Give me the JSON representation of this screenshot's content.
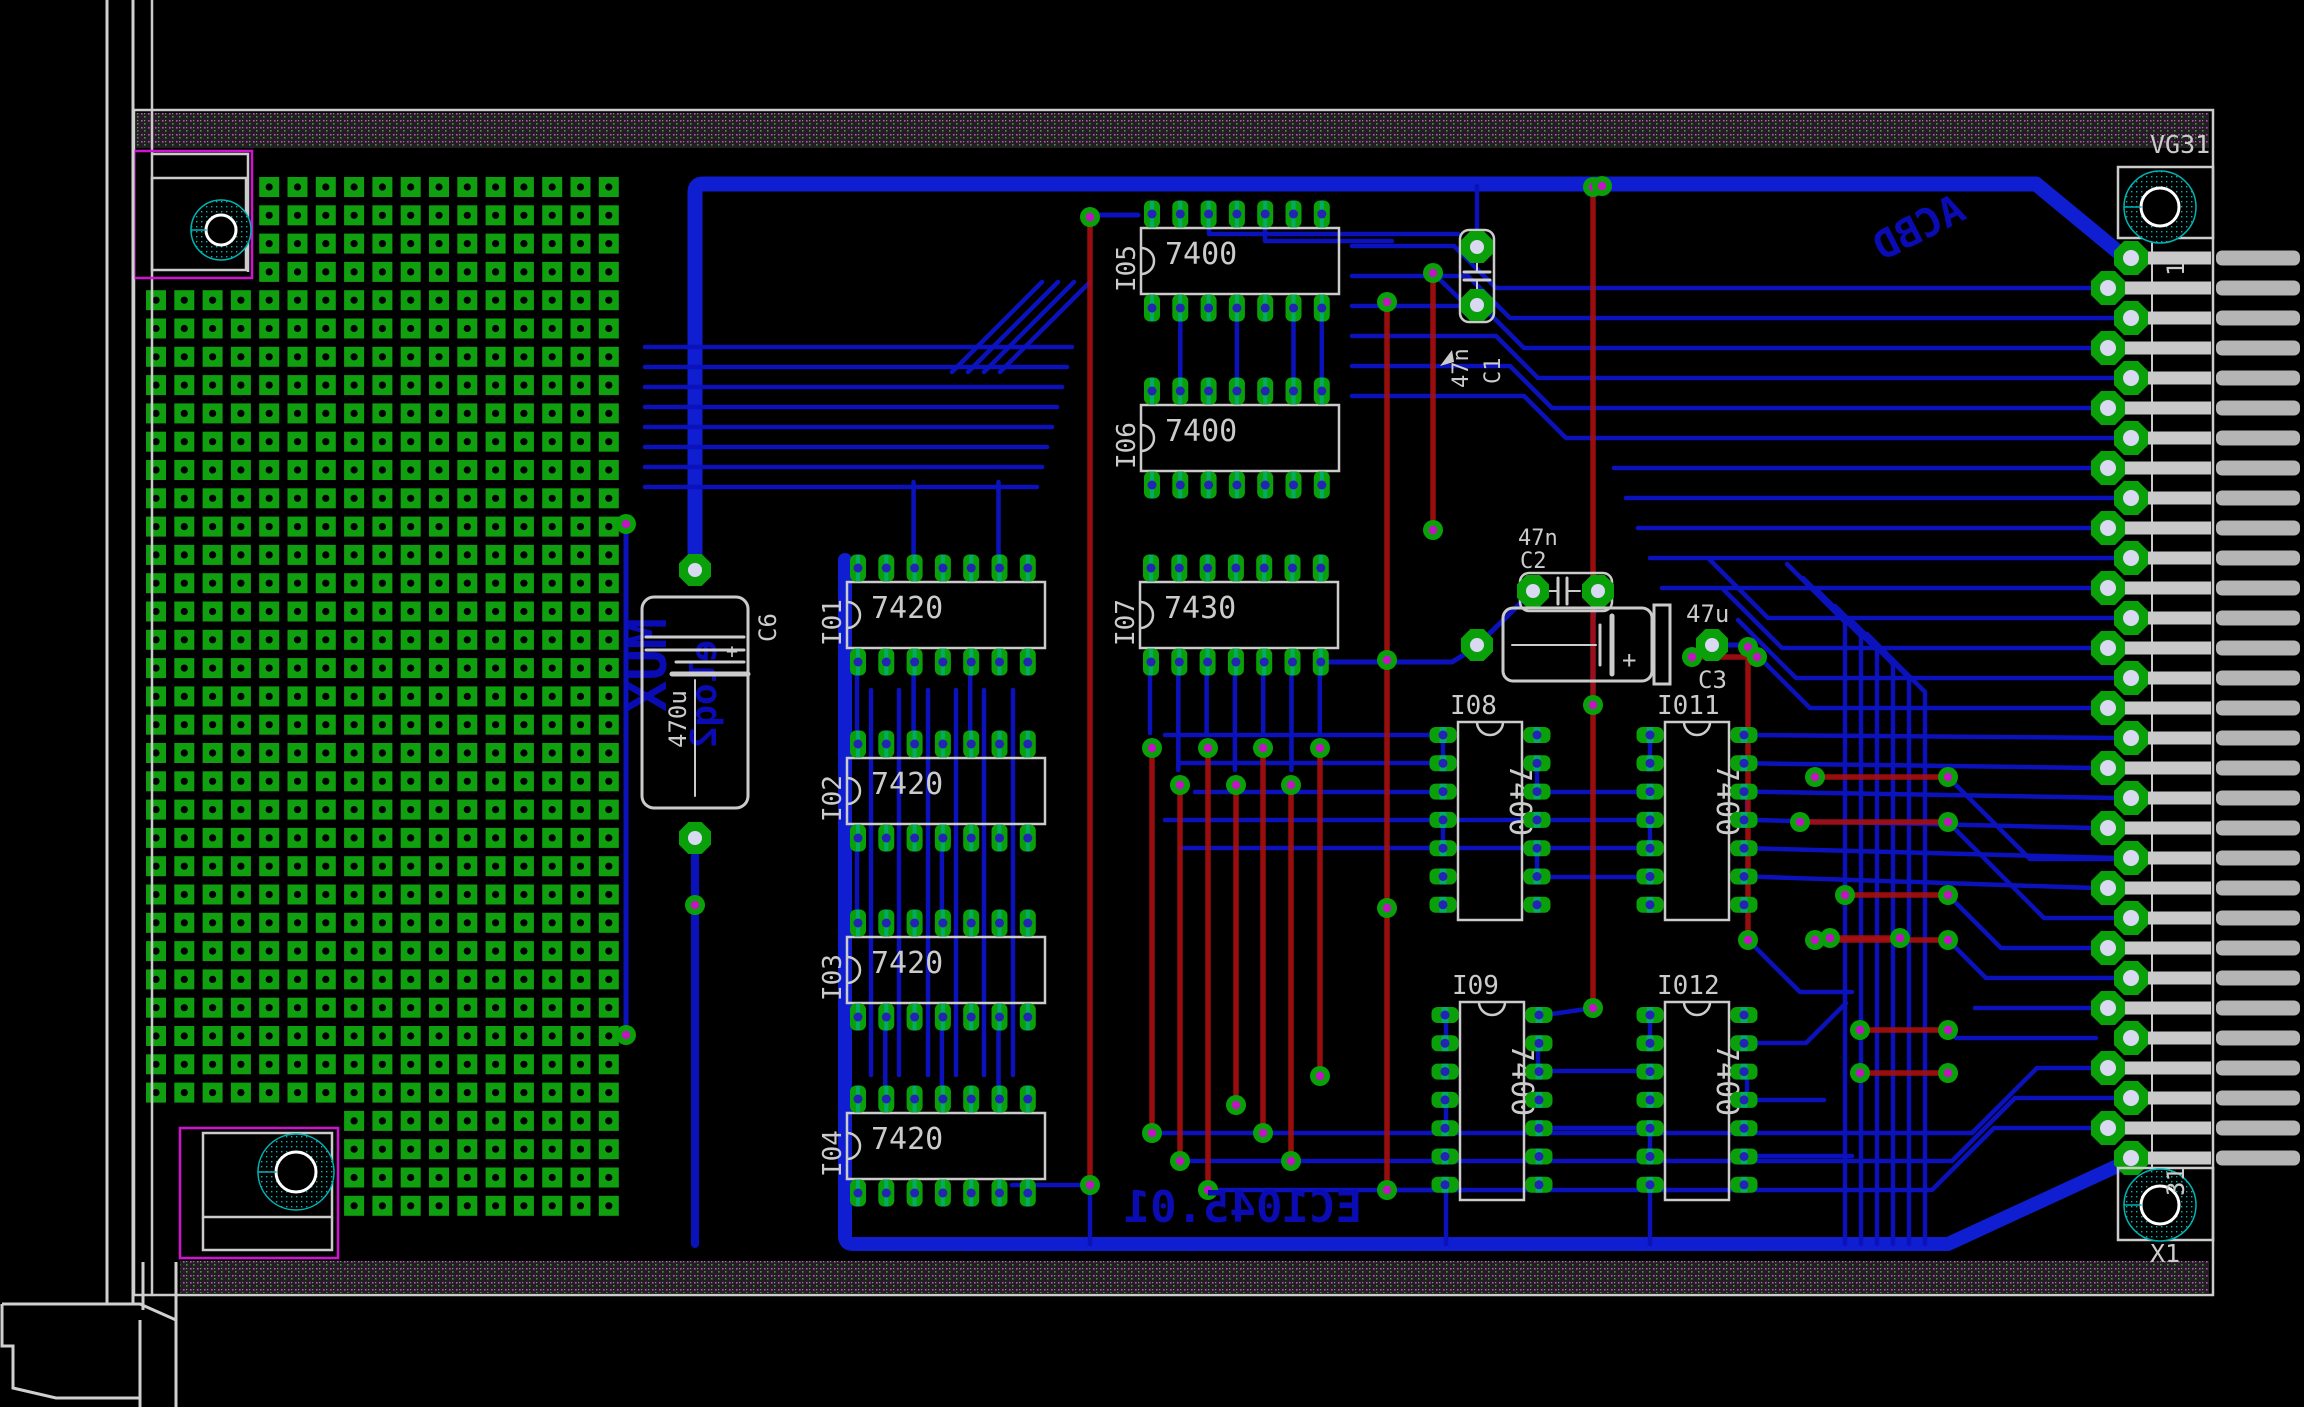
{
  "board": {
    "silkscreen": {
      "connector_label": "VG31",
      "connector_ref": "X1",
      "pin_first_label": "1",
      "pin_last_label": "31"
    },
    "copper_texts": {
      "acbd": "ACBD",
      "board_id": "EC1045.01",
      "mux": "MUX",
      "misc": "eloq2"
    },
    "connector": {
      "pins": 31
    },
    "proto_grid": {
      "cols": 17,
      "rows": 37
    },
    "components": [
      {
        "ref": "I01",
        "value": "7420",
        "type": "dip-h",
        "x": 847,
        "y": 582
      },
      {
        "ref": "I02",
        "value": "7420",
        "type": "dip-h",
        "x": 847,
        "y": 758
      },
      {
        "ref": "I03",
        "value": "7420",
        "type": "dip-h",
        "x": 847,
        "y": 937
      },
      {
        "ref": "I04",
        "value": "7420",
        "type": "dip-h",
        "x": 847,
        "y": 1113
      },
      {
        "ref": "I05",
        "value": "7400",
        "type": "dip-h",
        "x": 1141,
        "y": 228
      },
      {
        "ref": "I06",
        "value": "7400",
        "type": "dip-h",
        "x": 1141,
        "y": 405
      },
      {
        "ref": "I07",
        "value": "7430",
        "type": "dip-h",
        "x": 1140,
        "y": 582
      },
      {
        "ref": "I08",
        "value": "7400",
        "type": "dip-v",
        "x": 1458,
        "y": 722
      },
      {
        "ref": "I011",
        "value": "7400",
        "type": "dip-v",
        "x": 1665,
        "y": 722
      },
      {
        "ref": "I09",
        "value": "7400",
        "type": "dip-v",
        "x": 1460,
        "y": 1002
      },
      {
        "ref": "I012",
        "value": "7400",
        "type": "dip-v",
        "x": 1665,
        "y": 1002
      },
      {
        "ref": "C1",
        "value": "47n",
        "type": "cap-v",
        "x": 1460,
        "y": 230
      },
      {
        "ref": "C2",
        "value": "47n",
        "type": "cap-h",
        "x": 1520,
        "y": 573
      },
      {
        "ref": "C3",
        "value": "47u",
        "type": "elco-h",
        "x": 1503,
        "y": 608
      },
      {
        "ref": "C6",
        "value": "470u",
        "type": "elco-v",
        "x": 642,
        "y": 597
      }
    ],
    "colors": {
      "bg": "#000000",
      "silk": "#cbcbcb",
      "trace": "#0b12bb",
      "trace_bright": "#0f1ed0",
      "red": "#a50f0f",
      "pad_green": "#0aa00a",
      "grid_green": "#0f9f0f",
      "teal": "#00b4b4",
      "hole_navy": "#2323b4",
      "via_magenta": "#c215c2",
      "pale": "#d9d9f2",
      "finger": "#b5b5b5",
      "keepout": "#cf13cf",
      "copper_text": "#0b0bb4",
      "hatch_bg": "#262026"
    }
  }
}
